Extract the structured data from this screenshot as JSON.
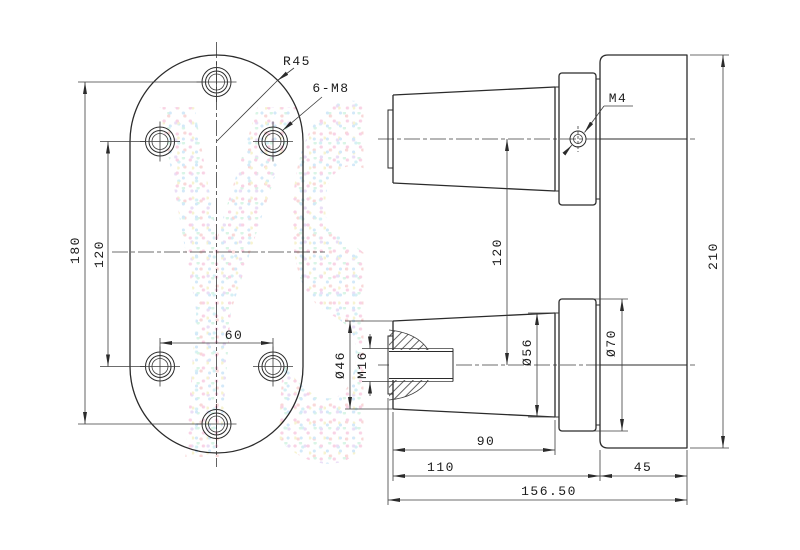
{
  "watermark": {
    "text": "YSDO",
    "dot_colors": [
      "#f5aecf",
      "#aed6f5",
      "#b9ecd2",
      "#f0eaaa",
      "#d9c2ef"
    ]
  },
  "line_color": "#2b2b2b",
  "front": {
    "overall_height": "180",
    "hole_row_spacing": "120",
    "hole_col_spacing": "60",
    "corner_radius": "R45",
    "holes_label": "6-M8"
  },
  "side": {
    "set_screw": "M4",
    "shaft_center_distance": "120",
    "body_height": "210",
    "shaft_end_diameter": "Ø46",
    "thread": "M16",
    "shaft_base_diameter": "Ø56",
    "flange_diameter": "Ø70",
    "taper_length": "90",
    "shaft_length": "110",
    "body_depth": "45",
    "total_length": "156.50"
  }
}
